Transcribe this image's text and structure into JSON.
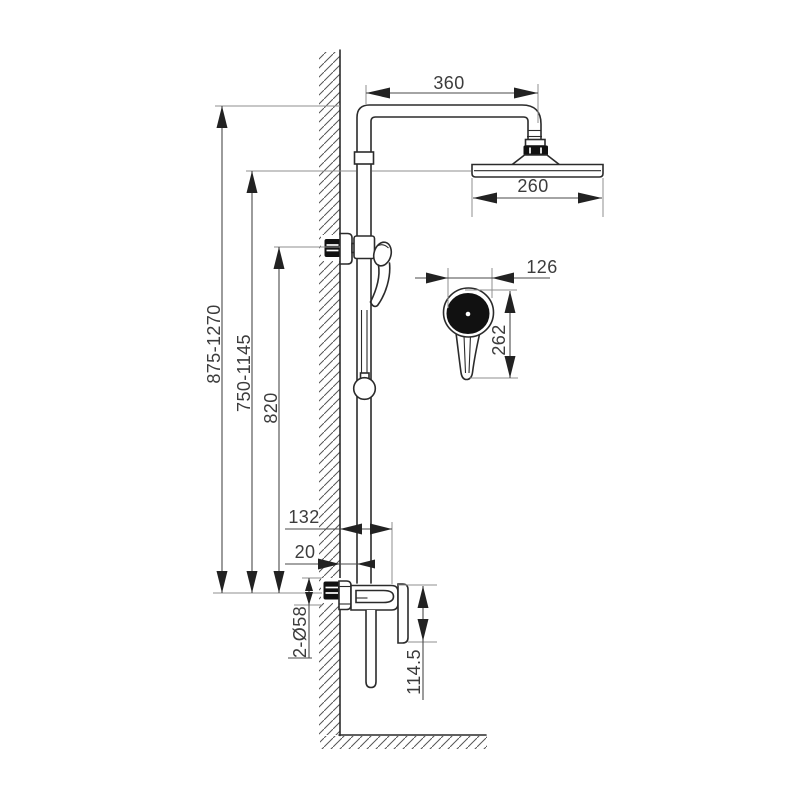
{
  "diagram": {
    "labels": {
      "arm_length": "360",
      "overhead_width": "260",
      "overall_height": "875-1270",
      "riser_height": "750-1145",
      "bar_height": "820",
      "hand_shower_width": "126",
      "hand_shower_height": "262",
      "valve_projection": "132",
      "wall_offset": "20",
      "mount_diameter": "2-Ø58",
      "valve_height": "114.5"
    },
    "colors": {
      "outline": "#2b2b2b",
      "dimension_line": "#4a4a4a",
      "extension_line": "#8f8f8f",
      "dark_fill": "#111111",
      "background": "#ffffff"
    }
  }
}
